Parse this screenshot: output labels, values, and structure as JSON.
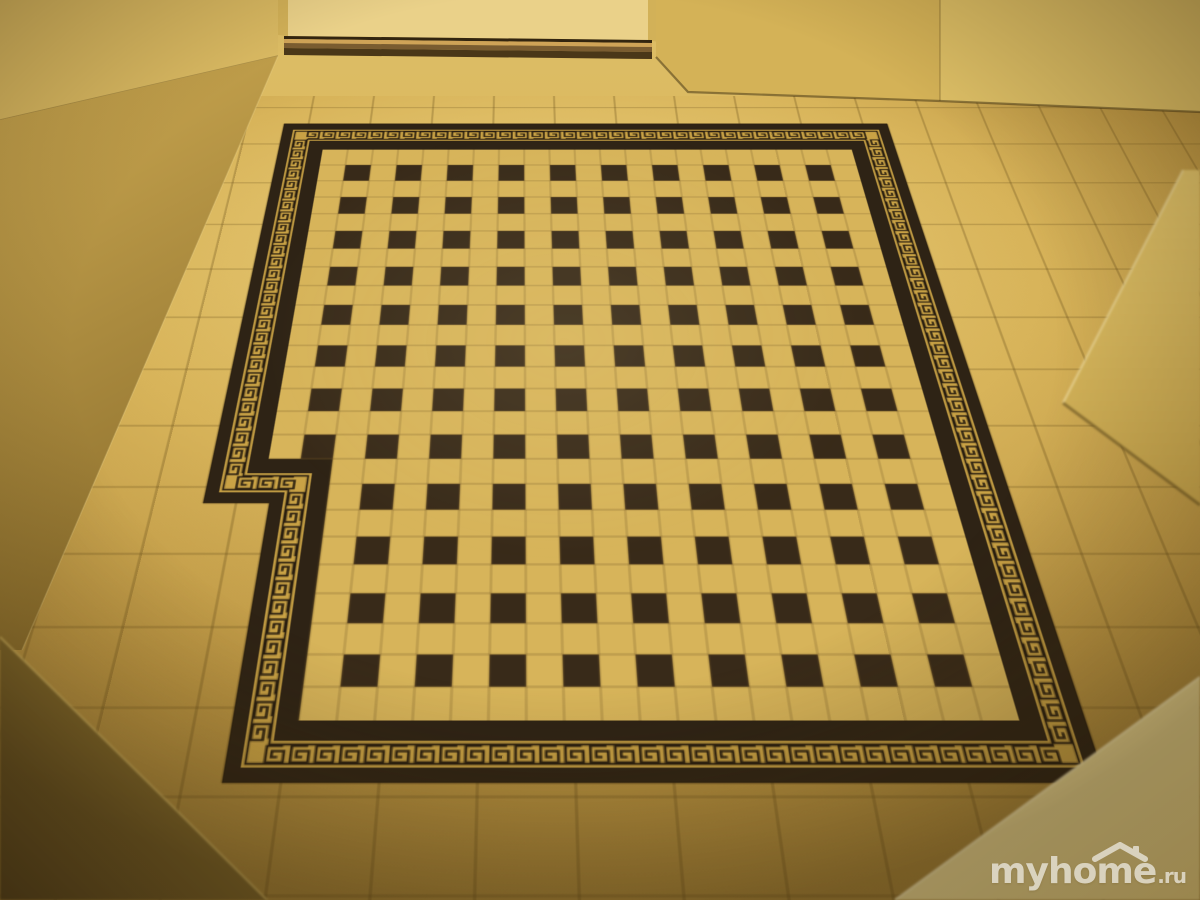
{
  "image": {
    "type": "photograph",
    "subject": "hallway floor with black-and-gold Greek key tile carpet",
    "width": 1200,
    "height": 900
  },
  "watermark": {
    "text": "myhome",
    "suffix": ".ru",
    "icon": "roof-icon",
    "color": "#ffffff"
  },
  "palette": {
    "floor_light": "#ecd07c",
    "floor_mid": "#d8b45a",
    "floor_far": "#bb9543",
    "floor_dark": "#9c7b33",
    "grout": "rgba(105,80,28,0.5)",
    "carpet_dark": "#2e2315",
    "carpet_gold": "#c9a245",
    "carpet_field": "#d7b45a",
    "carpet_dark_tile": "#382a19",
    "carpet_field_grout": "rgba(125,95,40,0.55)",
    "glyph_dark": "#2a1f10",
    "door_panel": "#ead189",
    "door_jamb": "#d2b158",
    "threshold_gap": "#33250f",
    "threshold_bright": "#cfa357",
    "threshold_mid": "#7a5c30",
    "threshold_dark": "#4a3718",
    "wall_top_left": "#d9b962",
    "wall_top_right_a": "#d4b257",
    "wall_top_right_b": "#ddbf66",
    "wall_left_top": "#cdaa52",
    "wall_left_bottom": "#8a6d2c",
    "wall_right_top": "#e2c56c",
    "wall_right_bottom": "#c8a64d",
    "wall_fg_right_light": "#f2e3a6",
    "wall_fg_right_dark": "#dfc77a",
    "wall_fg_left_light": "#a88a38",
    "wall_fg_left_dark": "#4f3d1a",
    "edge_shadow": "rgba(60,45,15,0.5)",
    "edge_highlight": "rgba(246,232,180,0.85)"
  },
  "floor": {
    "plain_tile_size": 60
  },
  "carpet": {
    "field_cols": 21,
    "field_rows": 25,
    "tile_size": 24,
    "dark_tile_rule": "dark tile at every odd row and odd column",
    "dark_cols": 10,
    "dark_rows": 12,
    "notch": {
      "side": "bottom-left",
      "cols": 2,
      "rows": 9
    },
    "bands": {
      "outer": 10,
      "meander": 18,
      "inner": 14
    },
    "glyph": "greek-key-spiral",
    "glyph_size": 11,
    "glyph_spacing": 15.5
  }
}
